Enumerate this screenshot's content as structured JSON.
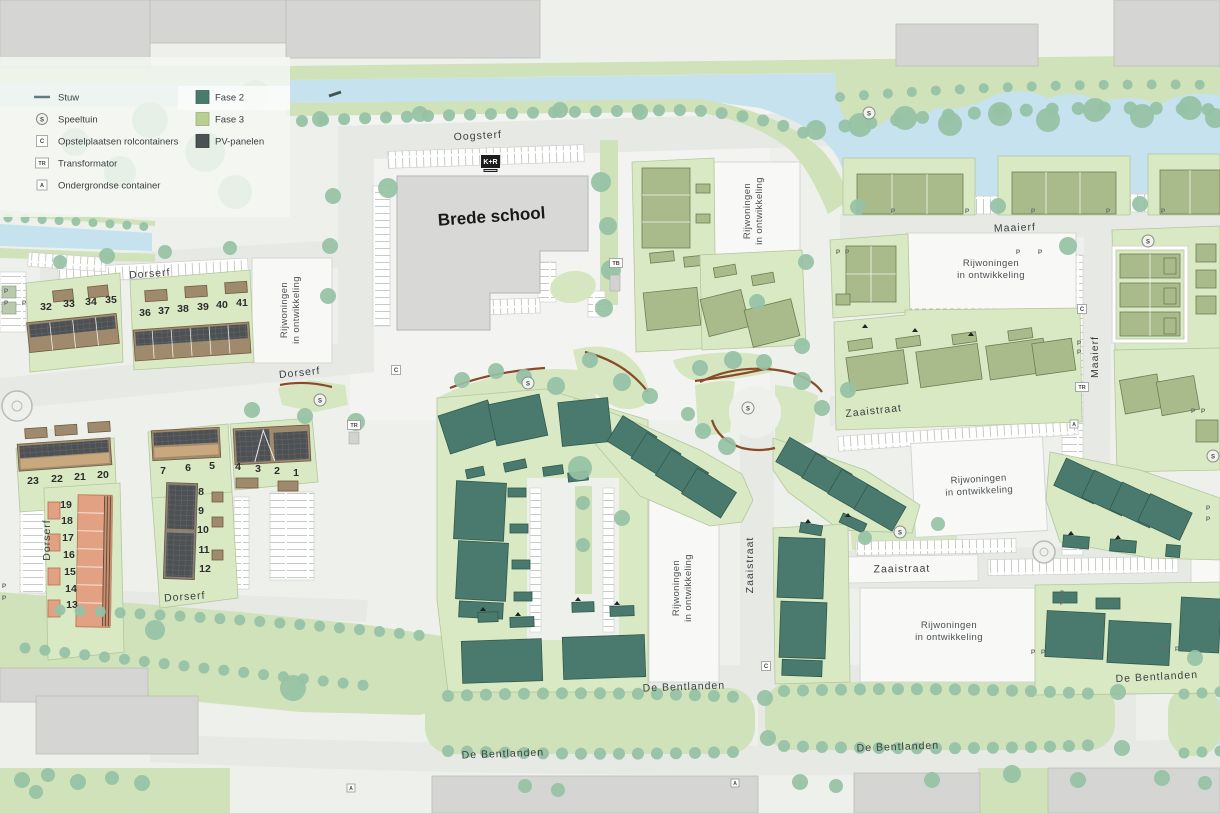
{
  "legend": {
    "col1": [
      {
        "symbol": "stuw-line",
        "label": "Stuw"
      },
      {
        "symbol": "S",
        "label": "Speeltuin"
      },
      {
        "symbol": "C",
        "label": "Opstelplaatsen rolcontainers"
      },
      {
        "symbol": "TR",
        "label": "Transformator"
      },
      {
        "symbol": "A",
        "label": "Ondergrondse container"
      }
    ],
    "col2": [
      {
        "swatch": "#4a7a6e",
        "label": "Fase 2"
      },
      {
        "swatch": "#b9ce92",
        "label": "Fase 3"
      },
      {
        "swatch": "#4b5053",
        "label": "PV-panelen"
      }
    ],
    "symbols": {
      "s": "S",
      "c": "C",
      "tr": "TR",
      "a": "A"
    }
  },
  "labels": {
    "school": "Brede school",
    "kr": "K+R",
    "dev1": "Rijwoningen",
    "dev2": "in ontwikkeling"
  },
  "streets": {
    "oogsterf": "Oogsterf",
    "dorserf": "Dorserf",
    "maaierf": "Maaierf",
    "zaaistraat": "Zaaistraat",
    "bentlanden": "De Bentlanden"
  },
  "markers": {
    "s": "S",
    "c": "C",
    "tr": "TR",
    "tb": "TB",
    "a": "A",
    "p": "P"
  },
  "plots": {
    "1": "1",
    "2": "2",
    "3": "3",
    "4": "4",
    "5": "5",
    "6": "6",
    "7": "7",
    "8": "8",
    "9": "9",
    "10": "10",
    "11": "11",
    "12": "12",
    "13": "13",
    "14": "14",
    "15": "15",
    "16": "16",
    "17": "17",
    "18": "18",
    "19": "19",
    "20": "20",
    "21": "21",
    "22": "22",
    "23": "23",
    "32": "32",
    "33": "33",
    "34": "34",
    "35": "35",
    "36": "36",
    "37": "37",
    "38": "38",
    "39": "39",
    "40": "40",
    "41": "41"
  },
  "colors": {
    "fase2": "#4a7a6e",
    "fase3": "#b9ce92",
    "pv_panelen": "#4b5053",
    "water": "#c6e2ee",
    "green": "#cfe2ba",
    "road": "#e7e9e5",
    "existing_building": "#d5d6d3"
  }
}
